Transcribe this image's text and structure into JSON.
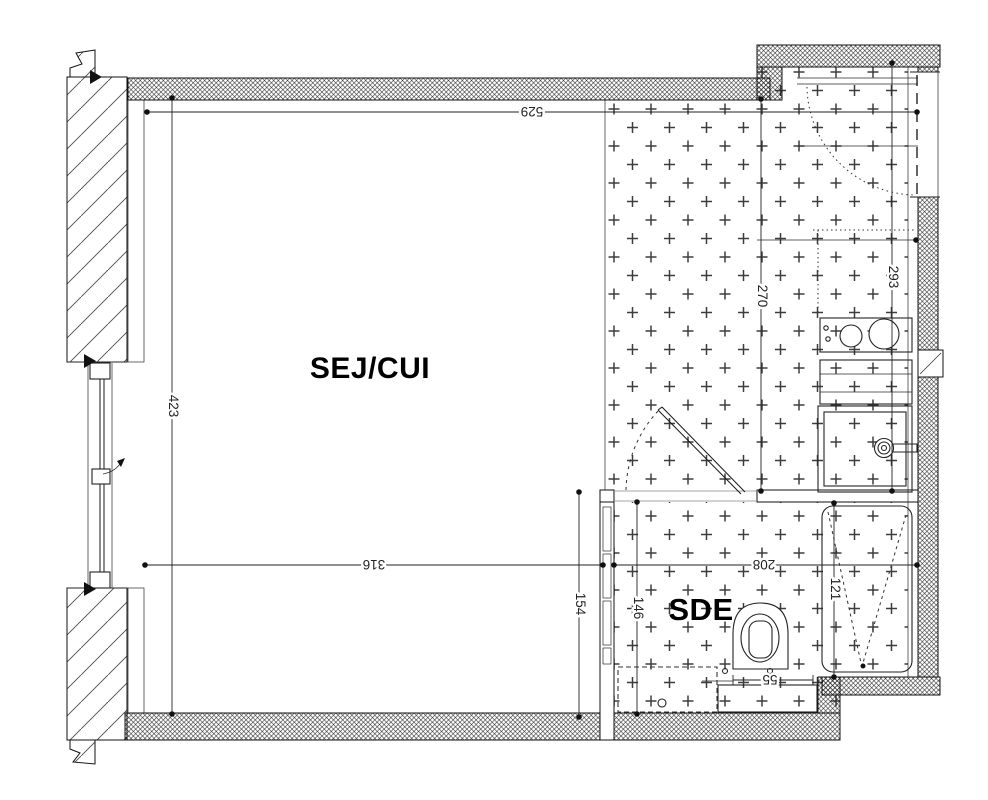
{
  "rooms": {
    "living": "SEJ/CUI",
    "bathroom": "SDE"
  },
  "dims": {
    "overall_width": "529",
    "overall_height": "423",
    "sej_width": "316",
    "kitchen_width": "270",
    "entry_height": "293",
    "sde_left_height": "154",
    "sde_inner_height": "146",
    "sde_width": "208",
    "bath_length": "121",
    "wc_unit_width": "55"
  },
  "colors": {
    "line": "#1a1a1a",
    "dim_text": "#242424",
    "background": "#ffffff"
  }
}
